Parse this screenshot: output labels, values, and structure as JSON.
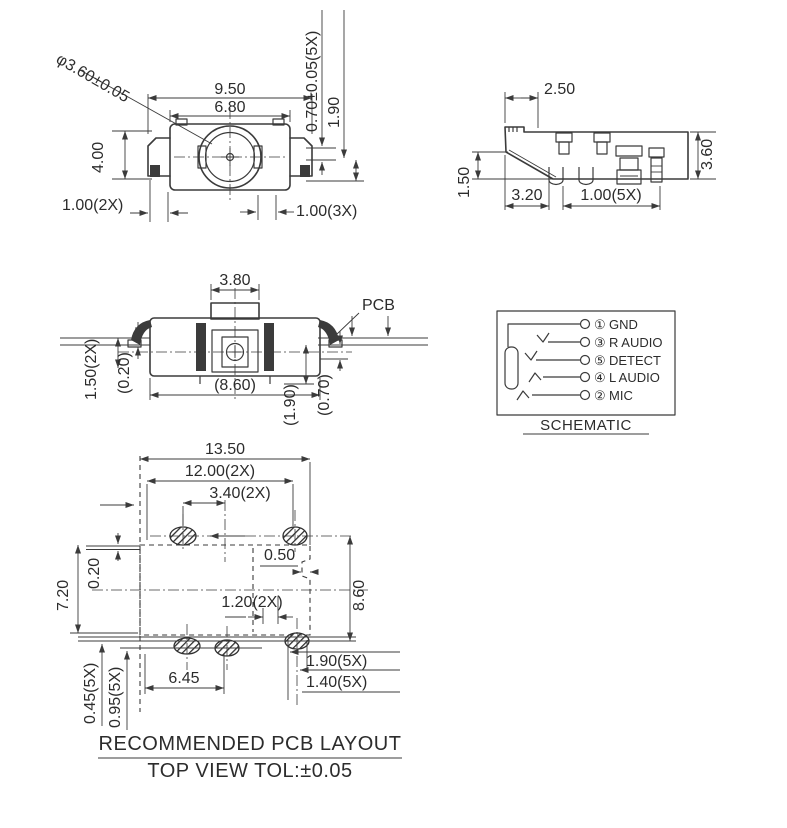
{
  "colors": {
    "ink": "#3b3b3b",
    "background": "#ffffff"
  },
  "front_view": {
    "d_diameter": "φ3.60±0.05",
    "d_950": "9.50",
    "d_680": "6.80",
    "d_070": "0.70±0.05(5X)",
    "d_190": "1.90",
    "d_400": "4.00",
    "d_100_2x": "1.00(2X)",
    "d_100_3x": "1.00(3X)"
  },
  "side_view": {
    "d_250": "2.50",
    "d_150": "1.50",
    "d_320": "3.20",
    "d_100_5x": "1.00(5X)",
    "d_360": "3.60"
  },
  "section_view": {
    "d_380": "3.80",
    "pcb_label": "PCB",
    "d_150_2x": "1.50(2X)",
    "d_020": "(0.20)",
    "d_860": "(8.60)",
    "d_190": "(1.90)",
    "d_070": "(0.70)"
  },
  "schematic": {
    "caption": "SCHEMATIC",
    "pins": [
      {
        "num": "①",
        "label": "GND"
      },
      {
        "num": "③",
        "label": "R AUDIO"
      },
      {
        "num": "⑤",
        "label": "DETECT"
      },
      {
        "num": "④",
        "label": "L AUDIO"
      },
      {
        "num": "②",
        "label": "MIC"
      }
    ]
  },
  "pcb_layout": {
    "d_1350": "13.50",
    "d_1200": "12.00(2X)",
    "d_340": "3.40(2X)",
    "d_050": "0.50",
    "d_020": "0.20",
    "d_720": "7.20",
    "d_860": "8.60",
    "d_120": "1.20(2X)",
    "d_190": "1.90(5X)",
    "d_140": "1.40(5X)",
    "d_645": "6.45",
    "d_045": "0.45(5X)",
    "d_095": "0.95(5X)"
  },
  "footer": {
    "line1": "RECOMMENDED PCB LAYOUT",
    "line2": "TOP VIEW TOL:±0.05"
  }
}
